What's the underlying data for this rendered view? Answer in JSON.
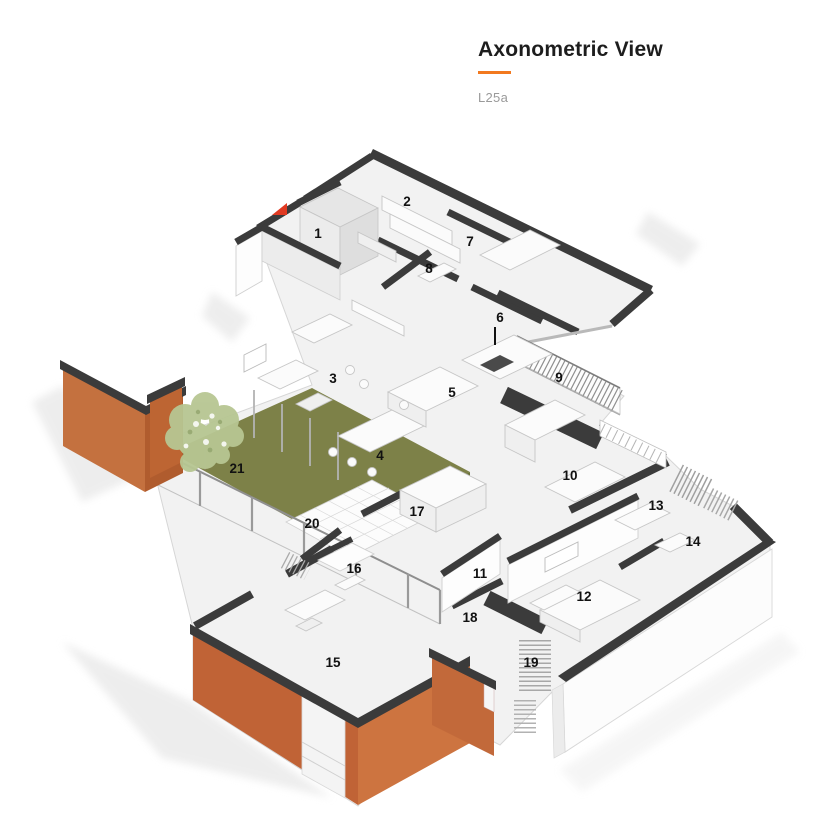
{
  "header": {
    "title": "Axonometric View",
    "subtitle": "L25a"
  },
  "plan": {
    "rooms": [
      {
        "label": "1"
      },
      {
        "label": "2"
      },
      {
        "label": "3"
      },
      {
        "label": "4"
      },
      {
        "label": "5"
      },
      {
        "label": "6"
      },
      {
        "label": "7"
      },
      {
        "label": "8"
      },
      {
        "label": "9"
      },
      {
        "label": "10"
      },
      {
        "label": "11"
      },
      {
        "label": "12"
      },
      {
        "label": "13"
      },
      {
        "label": "14"
      },
      {
        "label": "15"
      },
      {
        "label": "16"
      },
      {
        "label": "17"
      },
      {
        "label": "18"
      },
      {
        "label": "19"
      },
      {
        "label": "20"
      },
      {
        "label": "21"
      }
    ],
    "markers": {
      "north_arrow": "red-triangle"
    },
    "colors": {
      "accent_orange": "#f2791f",
      "facade_orange": "#c4713f",
      "facade_orange_dark": "#b05c2e",
      "wall_dark": "#3b3b3b",
      "garden_green": "#7d8148",
      "garden_green_dark": "#6a7139",
      "tree_green": "#b7c692",
      "floor_gray": "#f2f2f2"
    }
  }
}
